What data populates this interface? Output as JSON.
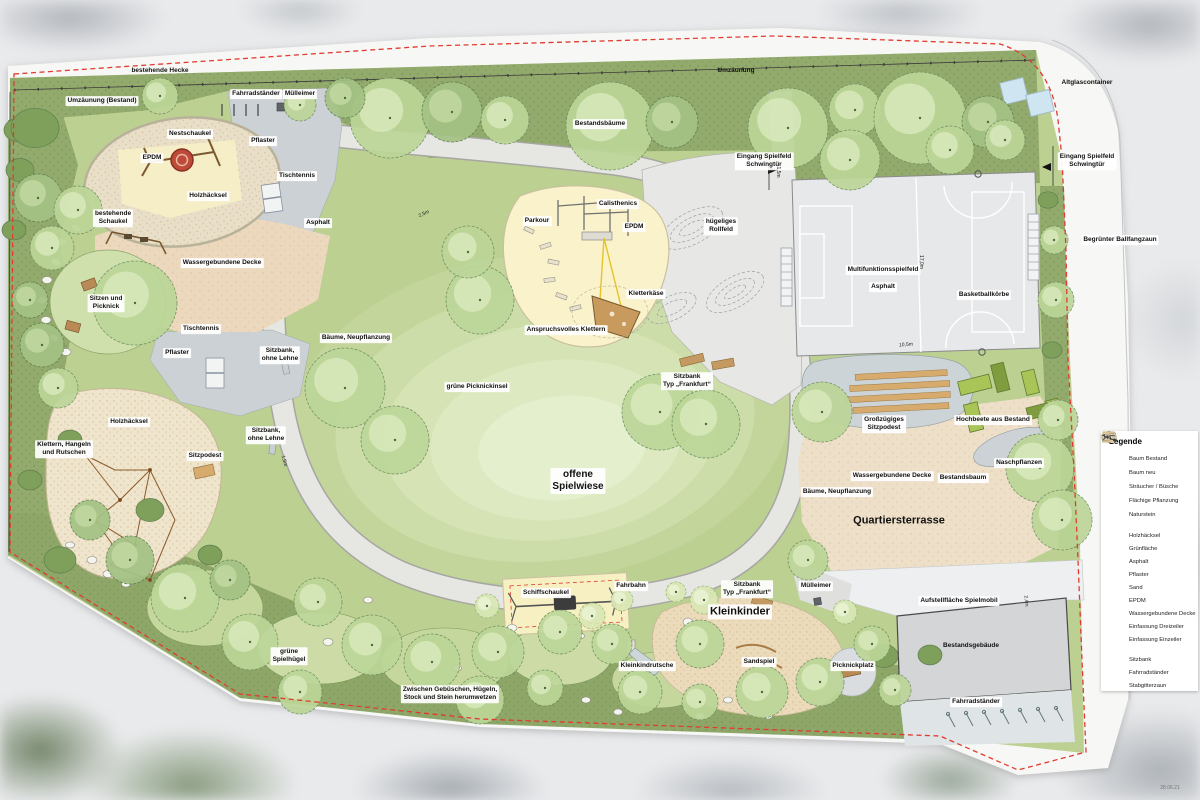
{
  "plan": {
    "labels": [
      {
        "t": "bestehende Hecke",
        "x": 160,
        "y": 71,
        "bg": false
      },
      {
        "t": "Umzäunung",
        "x": 736,
        "y": 71,
        "bg": false
      },
      {
        "t": "Altglascontainer",
        "x": 1087,
        "y": 83,
        "bg": false
      },
      {
        "t": "Umzäunung (Bestand)",
        "x": 102,
        "y": 101
      },
      {
        "t": "Fahrradständer",
        "x": 256,
        "y": 94
      },
      {
        "t": "Mülleimer",
        "x": 300,
        "y": 94
      },
      {
        "t": "Nestschaukel",
        "x": 190,
        "y": 134
      },
      {
        "t": "Pflaster",
        "x": 263,
        "y": 141
      },
      {
        "t": "EPDM",
        "x": 152,
        "y": 158
      },
      {
        "t": "Holzhäcksel",
        "x": 208,
        "y": 196
      },
      {
        "t": "Tischtennis",
        "x": 297,
        "y": 176
      },
      {
        "t": "bestehende\nSchaukel",
        "x": 113,
        "y": 218
      },
      {
        "t": "Asphalt",
        "x": 318,
        "y": 223
      },
      {
        "t": "Bestandsbäume",
        "x": 600,
        "y": 124
      },
      {
        "t": "Eingang Spielfeld\nSchwingtür",
        "x": 764,
        "y": 161
      },
      {
        "t": "Eingang Spielfeld\nSchwingtür",
        "x": 1087,
        "y": 161
      },
      {
        "t": "Begrünter Ballfangzaun",
        "x": 1120,
        "y": 240
      },
      {
        "t": "Wassergebundene Decke",
        "x": 222,
        "y": 263
      },
      {
        "t": "Sitzen und\nPicknick",
        "x": 106,
        "y": 303
      },
      {
        "t": "Tischtennis",
        "x": 201,
        "y": 329
      },
      {
        "t": "Pflaster",
        "x": 177,
        "y": 353
      },
      {
        "t": "Sitzbank,\nohne Lehne",
        "x": 280,
        "y": 355
      },
      {
        "t": "Parkour",
        "x": 537,
        "y": 221
      },
      {
        "t": "Calisthenics",
        "x": 618,
        "y": 204
      },
      {
        "t": "EPDM",
        "x": 634,
        "y": 227
      },
      {
        "t": "hügeliges\nRollfeld",
        "x": 721,
        "y": 226
      },
      {
        "t": "Kletterkäse",
        "x": 646,
        "y": 294
      },
      {
        "t": "Anspruchsvolles Klettern",
        "x": 566,
        "y": 330
      },
      {
        "t": "Multifunktionsspielfeld",
        "x": 883,
        "y": 270
      },
      {
        "t": "Asphalt",
        "x": 883,
        "y": 287
      },
      {
        "t": "Basketballkörbe",
        "x": 984,
        "y": 295
      },
      {
        "t": "Bäume, Neupflanzung",
        "x": 356,
        "y": 338
      },
      {
        "t": "grüne Picknickinsel",
        "x": 477,
        "y": 387
      },
      {
        "t": "Sitzbank\nTyp „Frankfurt“",
        "x": 687,
        "y": 381
      },
      {
        "t": "Sitzbank,\nohne Lehne",
        "x": 266,
        "y": 435
      },
      {
        "t": "Sitzpodest",
        "x": 205,
        "y": 456
      },
      {
        "t": "Klettern, Hangeln\nund Rutschen",
        "x": 64,
        "y": 449
      },
      {
        "t": "Holzhäcksel",
        "x": 129,
        "y": 422
      },
      {
        "t": "Großzügiges\nSitzpodest",
        "x": 884,
        "y": 424
      },
      {
        "t": "Hochbeete aus Bestand",
        "x": 993,
        "y": 420
      },
      {
        "t": "Naschpflanzen",
        "x": 1019,
        "y": 463
      },
      {
        "t": "Wassergebundene Decke",
        "x": 892,
        "y": 476
      },
      {
        "t": "Bestandsbaum",
        "x": 963,
        "y": 478
      },
      {
        "t": "Bäume, Neupflanzung",
        "x": 837,
        "y": 492
      },
      {
        "t": "Quartiersterrasse",
        "x": 899,
        "y": 521,
        "fs": 11,
        "bg": false
      },
      {
        "t": "offene\nSpielwiese",
        "x": 578,
        "y": 481,
        "fs": 10
      },
      {
        "t": "Fahrbahn",
        "x": 631,
        "y": 586
      },
      {
        "t": "Schiffschaukel",
        "x": 546,
        "y": 593
      },
      {
        "t": "Sitzbank\nTyp „Frankfurt“",
        "x": 747,
        "y": 589
      },
      {
        "t": "Mülleimer",
        "x": 816,
        "y": 586
      },
      {
        "t": "Kleinkinder",
        "x": 740,
        "y": 612,
        "fs": 11
      },
      {
        "t": "Kleinkindrutsche",
        "x": 647,
        "y": 666
      },
      {
        "t": "Sandspiel",
        "x": 759,
        "y": 662
      },
      {
        "t": "Picknickplatz",
        "x": 853,
        "y": 666
      },
      {
        "t": "Aufstellfläche Spielmobil",
        "x": 959,
        "y": 601
      },
      {
        "t": "Bestandsgebäude",
        "x": 971,
        "y": 646,
        "bg": false
      },
      {
        "t": "Fahrradständer",
        "x": 976,
        "y": 702
      },
      {
        "t": "grüne\nSpielhügel",
        "x": 289,
        "y": 656
      },
      {
        "t": "Zwischen Gebüschen, Hügeln,\nStock und Stein herumwetzen",
        "x": 450,
        "y": 694
      }
    ],
    "dimensions": [
      {
        "t": "2,5m",
        "x": 424,
        "y": 214,
        "rot": -25
      },
      {
        "t": "1,5m",
        "x": 284,
        "y": 461,
        "rot": 75
      },
      {
        "t": "17,0m",
        "x": 921,
        "y": 262,
        "rot": 90
      },
      {
        "t": "10,5m",
        "x": 906,
        "y": 345,
        "rot": -4
      },
      {
        "t": "1,5m",
        "x": 778,
        "y": 172,
        "rot": 90
      },
      {
        "t": "2,4m",
        "x": 1026,
        "y": 601,
        "rot": 85
      }
    ],
    "date_stamp": "28.06.21"
  },
  "legend": {
    "title": "Legende",
    "groups": [
      {
        "rows": [
          {
            "icon": "baum-bestand",
            "label": "Baum Bestand"
          },
          {
            "icon": "baum-neu",
            "label": "Baum neu"
          },
          {
            "icon": "straeucher",
            "label": "Sträucher / Büsche"
          },
          {
            "icon": "flaechige-pflanzung",
            "label": "Flächige Pflanzung"
          },
          {
            "icon": "naturstein",
            "label": "Naturstein"
          }
        ]
      },
      {
        "rows": [
          {
            "icon": "holzhaecksel",
            "label": "Holzhäcksel"
          },
          {
            "icon": "gruenflaeche",
            "label": "Grünfläche"
          },
          {
            "icon": "asphalt",
            "label": "Asphalt"
          },
          {
            "icon": "pflaster",
            "label": "Pflaster"
          },
          {
            "icon": "sand",
            "label": "Sand"
          },
          {
            "icon": "epdm",
            "label": "EPDM"
          },
          {
            "icon": "wgd",
            "label": "Wassergebundene Decke"
          },
          {
            "icon": "einfassung-dreizeiler",
            "label": "Einfassung Dreizeiler"
          },
          {
            "icon": "einfassung-einzeiler",
            "label": "Einfassung Einzeiler"
          }
        ]
      },
      {
        "rows": [
          {
            "icon": "sitzbank",
            "label": "Sitzbank"
          },
          {
            "icon": "fahrradstaender",
            "label": "Fahrradständer"
          },
          {
            "icon": "stabgitterzaun",
            "label": "Stabgitterzaun"
          }
        ]
      }
    ]
  },
  "colors": {
    "boundary_red": "#e13b30",
    "lawn": "#bcd092",
    "meadow_center": "#e3efcd",
    "asphalt": "#e6e6e2",
    "pflaster": "#ccd1d5",
    "sand": "#f8f1c8",
    "epdm": "#f9f2ca",
    "wassergebundene_decke": "#ecd9bd",
    "terrasse": "#eedfc8",
    "sportfeld": "#e6e8e9",
    "gebaeude": "#d4d5d6",
    "hochbeet": "#a9c557",
    "holzpodest": "#d7ab6e",
    "pflanzung_dunkel": "#93aa6d",
    "altglas_blau": "#cfe6f2"
  }
}
